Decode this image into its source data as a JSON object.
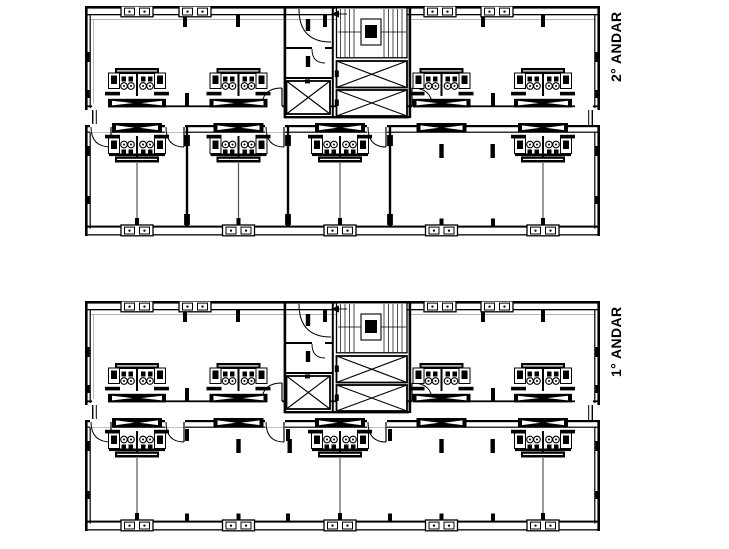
{
  "drawing": {
    "background": "#ffffff",
    "line_color": "#000000",
    "floors": [
      {
        "id": "2-andar",
        "label": "2° ANDAR",
        "lower_rooms": "divided"
      },
      {
        "id": "1-andar",
        "label": "1° ANDAR",
        "lower_rooms": "open"
      }
    ],
    "symbols": {
      "elevator": "square-with-x",
      "staircase": "hatched-treads-with-landing",
      "wc_cluster": "counter-sinks-toilets",
      "window": "double-square-with-dots",
      "louver_window": "black-bar-with-bowtie",
      "door": "quarter-arc"
    }
  }
}
